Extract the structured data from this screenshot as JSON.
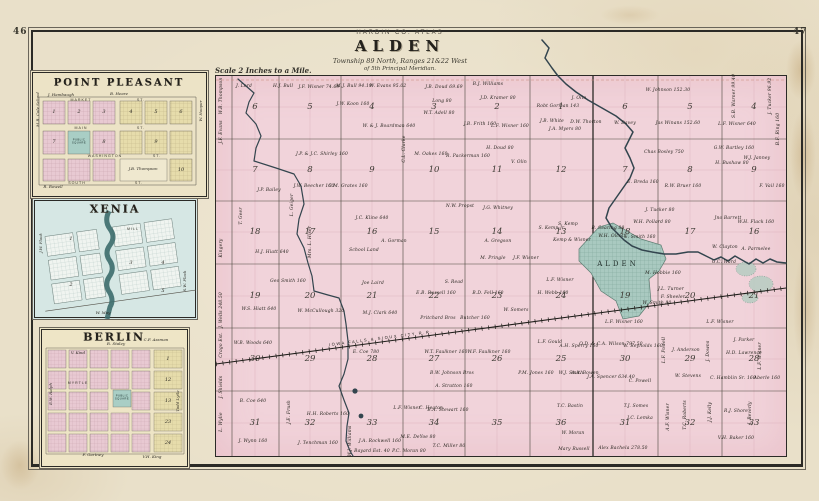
{
  "page": {
    "left_number": "46",
    "right_number": "47"
  },
  "title_block": {
    "atlas_line": "HARDIN CO. ATLAS",
    "map_name": "ALDEN",
    "township_line": "Township 89 North, Ranges 21&22 West",
    "meridian_line": "of 5th Principal Meridian.",
    "scale_note": "Scale 2 Inches to a Mile."
  },
  "colors": {
    "paper": "#e9e0c9",
    "map_pink": "#f1d3da",
    "town_teal": "#a9c9c0",
    "inset_blue": "#d6e7e4",
    "inset_cream": "#ece3c6",
    "block_pink": "#e8c9d2",
    "block_yellow": "#e6dcab",
    "square_teal": "#a9cec5",
    "river": "#33454e",
    "ink": "#2b2a26"
  },
  "main_map": {
    "town_label": "ALDEN",
    "railroad_label": "IOWA FALLS & SIOUX CITY R.R.",
    "geometry": {
      "base": {
        "x": 215,
        "y": 75
      },
      "left_col_centers": [
        254,
        309,
        371,
        433,
        496,
        560
      ],
      "right_col_centers": [
        624,
        689,
        753
      ],
      "row_centers": [
        106,
        169,
        231,
        295,
        358,
        422
      ]
    },
    "sections_left": [
      [
        6,
        5,
        4,
        3,
        2,
        1
      ],
      [
        7,
        8,
        9,
        10,
        11,
        12
      ],
      [
        18,
        17,
        16,
        15,
        14,
        13
      ],
      [
        19,
        20,
        21,
        22,
        23,
        24
      ],
      [
        30,
        29,
        28,
        27,
        26,
        25
      ],
      [
        31,
        32,
        33,
        34,
        35,
        36
      ]
    ],
    "sections_right": [
      [
        6,
        5,
        4
      ],
      [
        7,
        8,
        9
      ],
      [
        18,
        17,
        16
      ],
      [
        19,
        20,
        21
      ],
      [
        30,
        29,
        28
      ],
      [
        31,
        32,
        33
      ]
    ],
    "edge_names": [
      {
        "n": "W.B. Thompson",
        "y": 95
      },
      {
        "n": "J.F. Evans",
        "y": 131
      },
      {
        "n": "Kingery",
        "y": 247
      },
      {
        "n": "J. Wells 248.50",
        "y": 309
      },
      {
        "n": "Crago Est.",
        "y": 344
      },
      {
        "n": "J. Shields",
        "y": 386
      },
      {
        "n": "L. Wylie",
        "y": 421
      }
    ],
    "parcels": [
      {
        "n": "J. Lord",
        "x": 243,
        "y": 86
      },
      {
        "n": "H.J. Bull",
        "x": 282,
        "y": 86
      },
      {
        "n": "J.F. Wisner 74.69",
        "x": 318,
        "y": 87
      },
      {
        "n": "M.J. Bull 94.19",
        "x": 353,
        "y": 86
      },
      {
        "n": "W. Evans 95.02",
        "x": 387,
        "y": 86
      },
      {
        "n": "J.W. Koon 160",
        "x": 352,
        "y": 104
      },
      {
        "n": "W. & J. Boardman 640",
        "x": 388,
        "y": 126
      },
      {
        "n": "J.B. Doud 69.69",
        "x": 443,
        "y": 87
      },
      {
        "n": "Long 80",
        "x": 441,
        "y": 101
      },
      {
        "n": "W.T. Adell 80",
        "x": 438,
        "y": 113
      },
      {
        "n": "B.J. Williams",
        "x": 487,
        "y": 84
      },
      {
        "n": "J.D. Kramer 80",
        "x": 497,
        "y": 98
      },
      {
        "n": "J.B. Frith 160",
        "x": 479,
        "y": 124
      },
      {
        "n": "L.F. Wisner 160",
        "x": 509,
        "y": 126
      },
      {
        "n": "Robt Gorman 143",
        "x": 557,
        "y": 106
      },
      {
        "n": "J. Olin",
        "x": 578,
        "y": 98
      },
      {
        "n": "J.A. Myers 80",
        "x": 564,
        "y": 129
      },
      {
        "n": "J.B. White",
        "x": 551,
        "y": 121
      },
      {
        "n": "H. Doud 80",
        "x": 499,
        "y": 148
      },
      {
        "n": "V. Olin",
        "x": 518,
        "y": 162
      },
      {
        "n": "W. Johnson 152.30",
        "x": 667,
        "y": 90
      },
      {
        "n": "S.B. Warner 99.40",
        "x": 734,
        "y": 95,
        "r": 1
      },
      {
        "n": "J. Tucker 96.92",
        "x": 770,
        "y": 95,
        "r": 1
      },
      {
        "n": "L.F. Wisner 640",
        "x": 736,
        "y": 124
      },
      {
        "n": "B.F. Ring 160",
        "x": 778,
        "y": 128,
        "r": 1
      },
      {
        "n": "D.W. Thorton",
        "x": 585,
        "y": 122
      },
      {
        "n": "W. Davey",
        "x": 624,
        "y": 123
      },
      {
        "n": "Jas Winans 152.60",
        "x": 677,
        "y": 123
      },
      {
        "n": "J.P. & J.C. Shirley 160",
        "x": 321,
        "y": 154
      },
      {
        "n": "M. Oakes 160",
        "x": 430,
        "y": 154
      },
      {
        "n": "R. Packerman 160",
        "x": 467,
        "y": 156
      },
      {
        "n": "C.L. Clarke",
        "x": 404,
        "y": 148,
        "r": 1
      },
      {
        "n": "Chas Bosley 750",
        "x": 663,
        "y": 152
      },
      {
        "n": "E. Breda 160",
        "x": 642,
        "y": 182
      },
      {
        "n": "R.W. Bruer 160",
        "x": 682,
        "y": 186
      },
      {
        "n": "G.W. Bartley 160",
        "x": 733,
        "y": 148
      },
      {
        "n": "H. Bushaw 80",
        "x": 731,
        "y": 163
      },
      {
        "n": "W.J. Janney",
        "x": 756,
        "y": 158
      },
      {
        "n": "F. Vail 160",
        "x": 771,
        "y": 186
      },
      {
        "n": "J.W. Beecher 160",
        "x": 313,
        "y": 186
      },
      {
        "n": "C.M. Grates 160",
        "x": 347,
        "y": 186
      },
      {
        "n": "T. Geer",
        "x": 241,
        "y": 215,
        "r": 1
      },
      {
        "n": "L. Geiger",
        "x": 292,
        "y": 204,
        "r": 1
      },
      {
        "n": "J.P. Bailey",
        "x": 268,
        "y": 190
      },
      {
        "n": "H.J. Hiatt 640",
        "x": 271,
        "y": 252
      },
      {
        "n": "Mrs. L. Hiser",
        "x": 310,
        "y": 241,
        "r": 1
      },
      {
        "n": "J.C. Kline 640",
        "x": 371,
        "y": 218
      },
      {
        "n": "School Land",
        "x": 363,
        "y": 250
      },
      {
        "n": "A. Gorman",
        "x": 393,
        "y": 241
      },
      {
        "n": "J. Tucker 80",
        "x": 659,
        "y": 210
      },
      {
        "n": "Jno Barrett",
        "x": 727,
        "y": 218
      },
      {
        "n": "W.H. Flack 160",
        "x": 755,
        "y": 222
      },
      {
        "n": "W.H. Pollard 80",
        "x": 651,
        "y": 222
      },
      {
        "n": "N.W. Propst",
        "x": 459,
        "y": 206
      },
      {
        "n": "J.G. Whitney",
        "x": 497,
        "y": 208
      },
      {
        "n": "S. Kemp Jr.",
        "x": 551,
        "y": 228
      },
      {
        "n": "S. Kemp",
        "x": 567,
        "y": 224
      },
      {
        "n": "Kemp & Wisner",
        "x": 571,
        "y": 240
      },
      {
        "n": "B. Searing 80",
        "x": 607,
        "y": 228
      },
      {
        "n": "W.H. Olcott",
        "x": 611,
        "y": 236
      },
      {
        "n": "E. Smith 160",
        "x": 639,
        "y": 237
      },
      {
        "n": "W. Clayton",
        "x": 724,
        "y": 247
      },
      {
        "n": "A. Parmelee",
        "x": 755,
        "y": 249
      },
      {
        "n": "G.C. Ward",
        "x": 723,
        "y": 262
      },
      {
        "n": "M. Hobbie 160",
        "x": 662,
        "y": 273
      },
      {
        "n": "J.L. Turner",
        "x": 670,
        "y": 289
      },
      {
        "n": "F. Sheeler",
        "x": 672,
        "y": 297
      },
      {
        "n": "W. Smith 80",
        "x": 656,
        "y": 303
      },
      {
        "n": "A. Gregson",
        "x": 497,
        "y": 241
      },
      {
        "n": "M. Pringle",
        "x": 492,
        "y": 258
      },
      {
        "n": "J.F. Wisner",
        "x": 525,
        "y": 258
      },
      {
        "n": "S. Read",
        "x": 453,
        "y": 282
      },
      {
        "n": "Joe Laird",
        "x": 372,
        "y": 283
      },
      {
        "n": "Geo Smith 160",
        "x": 287,
        "y": 281
      },
      {
        "n": "L.F. Wisner",
        "x": 559,
        "y": 280
      },
      {
        "n": "L.F. Wisner 160",
        "x": 623,
        "y": 322
      },
      {
        "n": "L.F. Wisner",
        "x": 719,
        "y": 322
      },
      {
        "n": "W.S. Hiatt 640",
        "x": 258,
        "y": 309
      },
      {
        "n": "W. McCullough 320",
        "x": 320,
        "y": 311
      },
      {
        "n": "M.J. Clark 640",
        "x": 379,
        "y": 313
      },
      {
        "n": "Pritchard Bros",
        "x": 437,
        "y": 318
      },
      {
        "n": "Butcher 160",
        "x": 474,
        "y": 318
      },
      {
        "n": "W. Somers",
        "x": 515,
        "y": 310
      },
      {
        "n": "E.B. Russell 160",
        "x": 435,
        "y": 293
      },
      {
        "n": "B.D. Fell 160",
        "x": 487,
        "y": 293
      },
      {
        "n": "H. Webb 160",
        "x": 552,
        "y": 293
      },
      {
        "n": "W.B. Woods 640",
        "x": 252,
        "y": 343
      },
      {
        "n": "E. Coe 780",
        "x": 365,
        "y": 352
      },
      {
        "n": "W.T. Faulkner 160",
        "x": 445,
        "y": 352
      },
      {
        "n": "W.F. Faulkner 160",
        "x": 488,
        "y": 352
      },
      {
        "n": "L.F. Gould",
        "x": 549,
        "y": 342
      },
      {
        "n": "A.H. Sperry 160",
        "x": 578,
        "y": 346
      },
      {
        "n": "B.W. Johnson Bros",
        "x": 451,
        "y": 373
      },
      {
        "n": "A. Stratton 160",
        "x": 453,
        "y": 386
      },
      {
        "n": "P.M. Jones 160",
        "x": 535,
        "y": 373
      },
      {
        "n": "O.D. & C.A. Wilson 797.50",
        "x": 610,
        "y": 344
      },
      {
        "n": "W. Reynolds 160",
        "x": 642,
        "y": 346
      },
      {
        "n": "L.F. Powell",
        "x": 664,
        "y": 349,
        "r": 1
      },
      {
        "n": "J. Anderson",
        "x": 685,
        "y": 350
      },
      {
        "n": "J. Downs",
        "x": 708,
        "y": 350,
        "r": 1
      },
      {
        "n": "J. Parker",
        "x": 743,
        "y": 340
      },
      {
        "n": "H.D. Lawrence",
        "x": 743,
        "y": 353
      },
      {
        "n": "L.F. Wisner",
        "x": 760,
        "y": 355,
        "r": 1
      },
      {
        "n": "J.A. Spencer 634.40",
        "x": 610,
        "y": 377
      },
      {
        "n": "C. Powell",
        "x": 639,
        "y": 381
      },
      {
        "n": "W. Stevens",
        "x": 687,
        "y": 376
      },
      {
        "n": "C. Hamblin Sr. 160",
        "x": 732,
        "y": 378
      },
      {
        "n": "Aberle 160",
        "x": 766,
        "y": 378
      },
      {
        "n": "W.J. Smith",
        "x": 570,
        "y": 373
      },
      {
        "n": "A.A. Bowen",
        "x": 584,
        "y": 373
      },
      {
        "n": "B. Coe 640",
        "x": 252,
        "y": 401
      },
      {
        "n": "J.E. Frush",
        "x": 289,
        "y": 411,
        "r": 1
      },
      {
        "n": "H.H. Roberts 160",
        "x": 327,
        "y": 414
      },
      {
        "n": "J. Wynn 160",
        "x": 252,
        "y": 441
      },
      {
        "n": "J. Tenchman 160",
        "x": 317,
        "y": 443
      },
      {
        "n": "W.J. Williams",
        "x": 350,
        "y": 440,
        "r": 1
      },
      {
        "n": "L.F. Wisner",
        "x": 406,
        "y": 408
      },
      {
        "n": "C. Heaton",
        "x": 430,
        "y": 408
      },
      {
        "n": "B.A. Stewart 160",
        "x": 447,
        "y": 410
      },
      {
        "n": "M.E. DeYoe 80",
        "x": 417,
        "y": 437
      },
      {
        "n": "J.A. Rockwell 160",
        "x": 379,
        "y": 441
      },
      {
        "n": "P.C. Moran 80",
        "x": 408,
        "y": 451
      },
      {
        "n": "Bayard Est. 40",
        "x": 371,
        "y": 451
      },
      {
        "n": "T.C. Miller 80",
        "x": 448,
        "y": 446
      },
      {
        "n": "T.C. Bastin",
        "x": 569,
        "y": 406
      },
      {
        "n": "W. Moran",
        "x": 572,
        "y": 433
      },
      {
        "n": "Mary Russell",
        "x": 573,
        "y": 449
      },
      {
        "n": "Alex Bachela 278.50",
        "x": 622,
        "y": 448
      },
      {
        "n": "T.J. Somes",
        "x": 635,
        "y": 406
      },
      {
        "n": "J.C. Lemka",
        "x": 639,
        "y": 418
      },
      {
        "n": "A.F. Wisner",
        "x": 668,
        "y": 416,
        "r": 1
      },
      {
        "n": "T.C. Roberts",
        "x": 685,
        "y": 414,
        "r": 1
      },
      {
        "n": "J.J. Kelly",
        "x": 710,
        "y": 411,
        "r": 1
      },
      {
        "n": "R.J. Shore",
        "x": 735,
        "y": 411
      },
      {
        "n": "J. Beverly",
        "x": 750,
        "y": 412,
        "r": 1
      },
      {
        "n": "V.H. Baker 160",
        "x": 735,
        "y": 438
      }
    ]
  },
  "insets": {
    "point_pleasant": {
      "title": "POINT PLEASANT",
      "square_label": "PUBLIC SQUARE",
      "labels": [
        {
          "n": "J. Hambaugh",
          "x": 30,
          "y": 24
        },
        {
          "n": "B. Heare",
          "x": 88,
          "y": 23
        },
        {
          "n": "R. Rowell",
          "x": 22,
          "y": 116
        },
        {
          "n": "M.B. Cole",
          "x": 7,
          "y": 46,
          "r": 1
        },
        {
          "n": "School",
          "x": 7,
          "y": 28,
          "r": 1
        },
        {
          "n": "W. Hooper",
          "x": 170,
          "y": 40,
          "r": 1
        },
        {
          "n": "J.B. Thompson",
          "x": 112,
          "y": 98
        },
        {
          "n": "MARKET",
          "x": 50,
          "y": 29,
          "c": "street"
        },
        {
          "n": "ST.",
          "x": 110,
          "y": 29,
          "c": "street"
        },
        {
          "n": "MAIN",
          "x": 50,
          "y": 57,
          "c": "street"
        },
        {
          "n": "ST.",
          "x": 110,
          "y": 57,
          "c": "street"
        },
        {
          "n": "WASHINGTON",
          "x": 74,
          "y": 85,
          "c": "street"
        },
        {
          "n": "ST.",
          "x": 126,
          "y": 85,
          "c": "street"
        },
        {
          "n": "SOUTH",
          "x": 46,
          "y": 112,
          "c": "street"
        },
        {
          "n": "ST.",
          "x": 108,
          "y": 112,
          "c": "street"
        },
        {
          "n": "1",
          "x": 23,
          "y": 41,
          "c": "bignum"
        },
        {
          "n": "2",
          "x": 48,
          "y": 41,
          "c": "bignum"
        },
        {
          "n": "3",
          "x": 73,
          "y": 41,
          "c": "bignum"
        },
        {
          "n": "4",
          "x": 100,
          "y": 41,
          "c": "bignum"
        },
        {
          "n": "5",
          "x": 125,
          "y": 41,
          "c": "bignum"
        },
        {
          "n": "6",
          "x": 150,
          "y": 41,
          "c": "bignum"
        },
        {
          "n": "7",
          "x": 23,
          "y": 71,
          "c": "bignum"
        },
        {
          "n": "8",
          "x": 73,
          "y": 71,
          "c": "bignum"
        },
        {
          "n": "9",
          "x": 125,
          "y": 71,
          "c": "bignum"
        },
        {
          "n": "10",
          "x": 150,
          "y": 99,
          "c": "bignum"
        }
      ]
    },
    "xenia": {
      "title": "XENIA",
      "labels": [
        {
          "n": "J.W. Flack",
          "x": 8,
          "y": 44,
          "r": 1
        },
        {
          "n": "W. May",
          "x": 70,
          "y": 114
        },
        {
          "n": "S.W. Flack",
          "x": 152,
          "y": 82,
          "r": 1
        },
        {
          "n": "MILL",
          "x": 100,
          "y": 30,
          "c": "street"
        },
        {
          "n": "1",
          "x": 38,
          "y": 40,
          "c": "bignum"
        },
        {
          "n": "2",
          "x": 38,
          "y": 86,
          "c": "bignum"
        },
        {
          "n": "3",
          "x": 98,
          "y": 64,
          "c": "bignum"
        },
        {
          "n": "4",
          "x": 130,
          "y": 64,
          "c": "bignum"
        },
        {
          "n": "5",
          "x": 130,
          "y": 92,
          "c": "bignum"
        }
      ]
    },
    "berlin": {
      "title": "BERLIN",
      "square_label": "PUBLIC SQUARE",
      "labels": [
        {
          "n": "C.F. Assman",
          "x": 116,
          "y": 12
        },
        {
          "n": "R. Staley",
          "x": 76,
          "y": 16
        },
        {
          "n": "V. Kind",
          "x": 38,
          "y": 25
        },
        {
          "n": "E.W. Ralph",
          "x": 11,
          "y": 66,
          "r": 1
        },
        {
          "n": "Todd Lytle",
          "x": 138,
          "y": 73,
          "r": 1
        },
        {
          "n": "F. Gartney",
          "x": 53,
          "y": 127
        },
        {
          "n": "V.H. King",
          "x": 112,
          "y": 129
        },
        {
          "n": "MYRTLE",
          "x": 38,
          "y": 55,
          "c": "street"
        },
        {
          "n": "1",
          "x": 128,
          "y": 31,
          "c": "bignum"
        },
        {
          "n": "12",
          "x": 128,
          "y": 52,
          "c": "bignum"
        },
        {
          "n": "13",
          "x": 128,
          "y": 73,
          "c": "bignum"
        },
        {
          "n": "23",
          "x": 128,
          "y": 94,
          "c": "bignum"
        },
        {
          "n": "24",
          "x": 128,
          "y": 115,
          "c": "bignum"
        }
      ]
    }
  }
}
